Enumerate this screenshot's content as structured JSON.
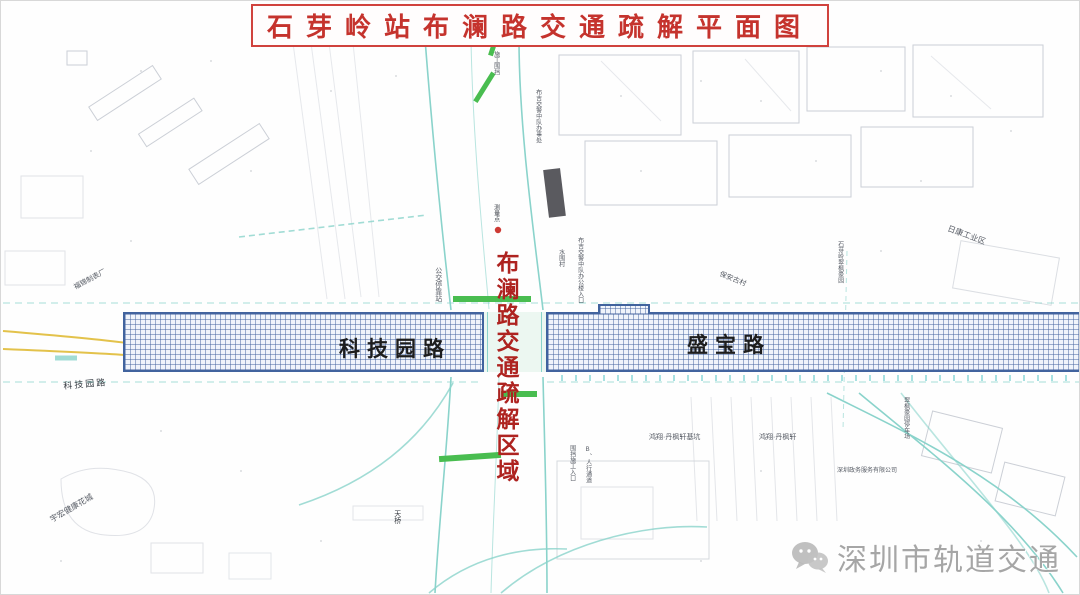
{
  "title": "石芽岭站布澜路交通疏解平面图",
  "zone_label": "布澜路交通疏解区域",
  "roads": {
    "left": "科技园路",
    "right": "盛宝路"
  },
  "watermark": {
    "brand": "深圳市轨道交通",
    "icon": "wechat-icon"
  },
  "map_labels": [
    {
      "text": "福锦制表厂"
    },
    {
      "text": "科技园路"
    },
    {
      "text": "宇宏健康花城"
    },
    {
      "text": "公交停靠站"
    },
    {
      "text": "施工围挡"
    },
    {
      "text": "布吉交警中队办事处"
    },
    {
      "text": "水围村"
    },
    {
      "text": "布吉交警中队办公楼入口"
    },
    {
      "text": "保安古村"
    },
    {
      "text": "日康工业区"
    },
    {
      "text": "石芽岭翠枫豪园"
    },
    {
      "text": "测量点"
    },
    {
      "text": "天桥"
    },
    {
      "text": "鸿翔·丹枫轩基坑"
    },
    {
      "text": "鸿翔·丹枫轩"
    },
    {
      "text": "围挡施工入口"
    },
    {
      "text": "B、人行通道"
    },
    {
      "text": "翠枫豪园停车场"
    },
    {
      "text": "深圳政务服务有限公司"
    }
  ],
  "colors": {
    "title_red": "#c5332d",
    "zone_red": "#ae2320",
    "hatch_blue": "#41639e",
    "utility_teal": "#8ad3cb",
    "signal_green": "#49bd50",
    "lane_yellow": "#e3c24b",
    "watermark_gray": "#9b9b9b"
  }
}
